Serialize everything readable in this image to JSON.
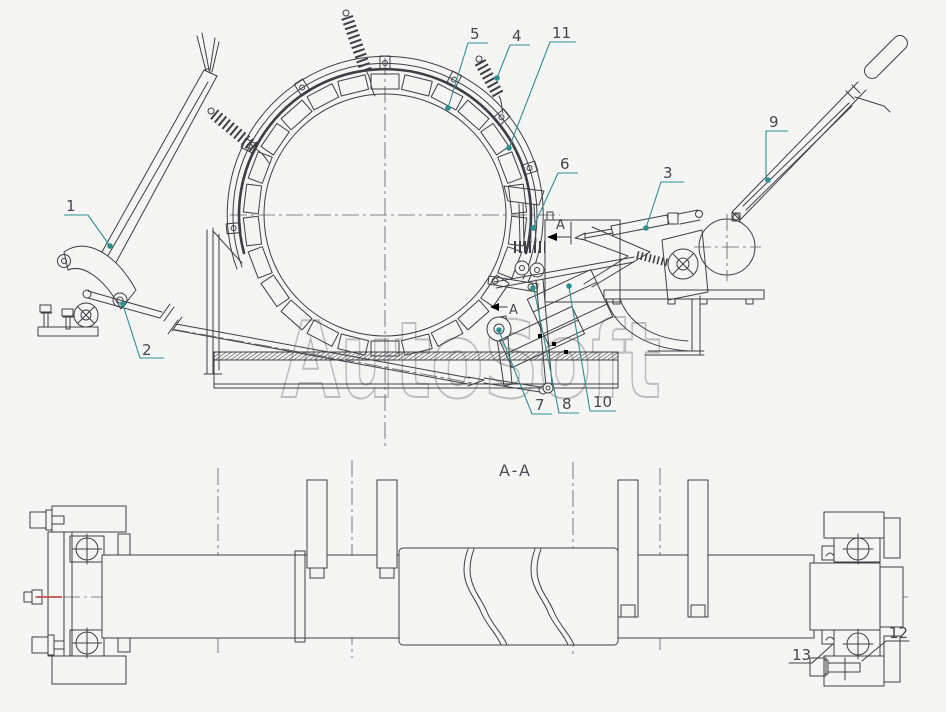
{
  "colors": {
    "background": "#f5f5f3",
    "line": "#3e3e46",
    "leader": "#2f8f90",
    "watermark": "#bdbdbd",
    "centerline_red_segment": "#c0504d",
    "label_text": "#45454c"
  },
  "watermark": {
    "text": "AutoSoft"
  },
  "main_view": {
    "section_letter": "A",
    "callouts": {
      "c1": "1",
      "c2": "2",
      "c3": "3",
      "c4": "4",
      "c5": "5",
      "c6": "6",
      "c7": "7",
      "c8": "8",
      "c9": "9",
      "c10": "10",
      "c11": "11"
    }
  },
  "section_view": {
    "title": "A-A",
    "callouts": {
      "c12": "12",
      "c13": "13"
    }
  }
}
